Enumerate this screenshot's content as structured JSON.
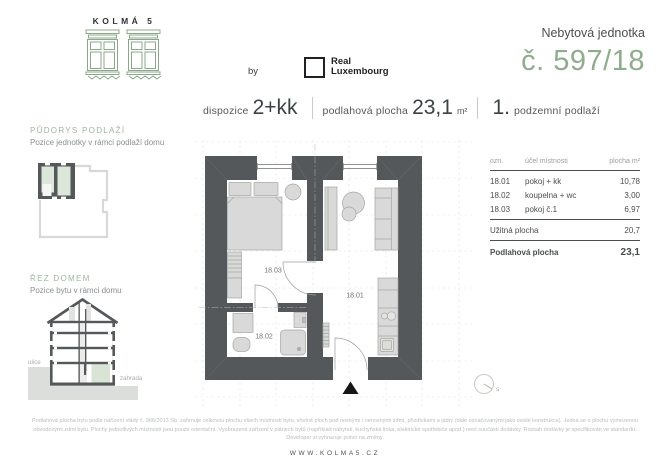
{
  "brand": {
    "logo_text": "KOLMÁ 5",
    "by_label": "by",
    "partner_line1": "Real",
    "partner_line2": "Luxembourg"
  },
  "unit": {
    "type_label": "Nebytová jednotka",
    "number": "č. 597/18"
  },
  "specs": {
    "dispozice_label": "dispozice",
    "dispozice_value": "2+kk",
    "area_label": "podlahová plocha",
    "area_value": "23,1",
    "area_unit": "m²",
    "floor_number": "1.",
    "floor_label": "podzemní podlaží"
  },
  "sidebar": {
    "plan_title": "PŮDORYS PODLAŽÍ",
    "plan_subtitle": "Pozice jednotky v rámci podlaží domu",
    "section_title": "ŘEZ DOMEM",
    "section_subtitle": "Pozice bytu v rámci domu",
    "street_label": "ulice",
    "garden_label": "zahrada"
  },
  "floorplan": {
    "room_18_01": "18.01",
    "room_18_02": "18.02",
    "room_18_03": "18.03",
    "compass_label": "s"
  },
  "table": {
    "headers": {
      "code": "ozn.",
      "purpose": "účel místnosti",
      "area": "plocha m²"
    },
    "rows": [
      {
        "code": "18.01",
        "purpose": "pokoj + kk",
        "area": "10,78"
      },
      {
        "code": "18.02",
        "purpose": "koupelna + wc",
        "area": "3,00"
      },
      {
        "code": "18.03",
        "purpose": "pokoj č.1",
        "area": "6,97"
      }
    ],
    "usable_label": "Užitná plocha",
    "usable_value": "20,7",
    "total_label": "Podlahová plocha",
    "total_value": "23,1"
  },
  "footer": {
    "disclaimer": "Podlahová plocha bytu podle nařízení vlády č. 366/2013 Sb. zahrnuje celkovou plochu všech místností bytu, včetně ploch pod nosnými i nenosnými zdmi, přizdívkami a jádry (dále označovanými jako svislé konstrukce). Jedná se o plochu vymezenou obvodovými zdmi bytu. Plochy jednotlivých místností jsou pouze orientační. Vyobrazené zařízení v plánech bytů (například nábytek, kuchyňská linka, elektrické spotřebiče apod.) není součástí dodávky. Rozsah dodávky je specifikován ve standardu. Developer si vyhrazuje právo na změny.",
    "website": "WWW.KOLMA5.CZ"
  },
  "colors": {
    "green": "#8FAC8C",
    "light_green": "#DDE7D9",
    "wall": "#54585A",
    "ground_gray": "#DCDEDC"
  }
}
